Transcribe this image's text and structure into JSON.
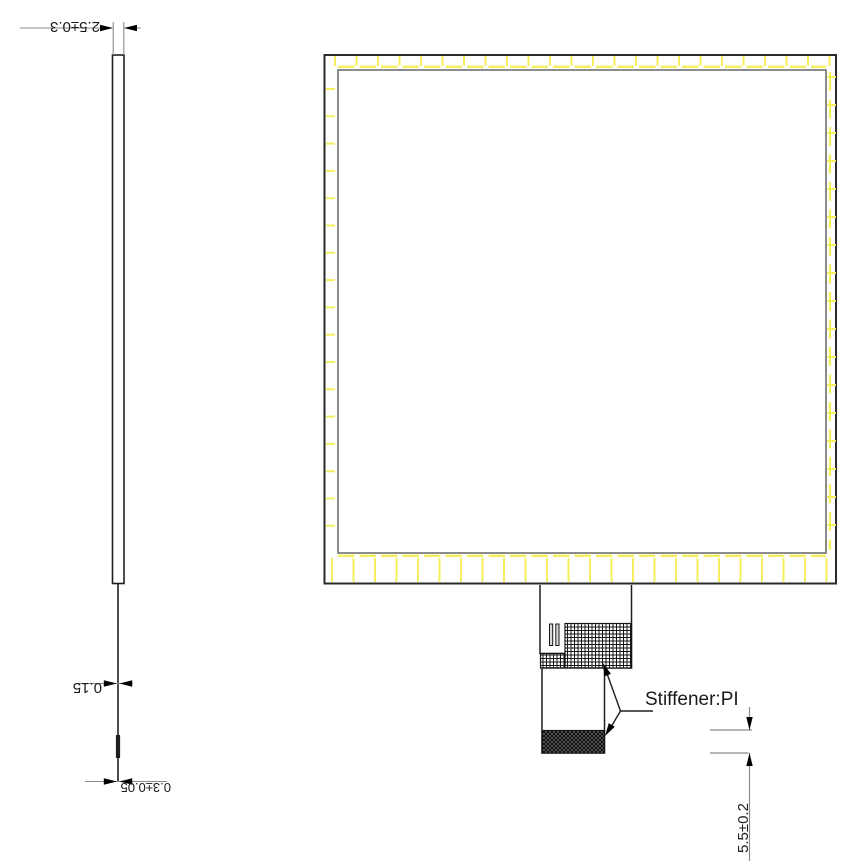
{
  "side_view": {
    "dims": {
      "overall_thickness": "2.5±0.3",
      "fpc_thickness": "0.15",
      "stiffener_thickness": "0.3±0.05"
    }
  },
  "front_view": {
    "stiffener_label": "Stiffener:PI",
    "dims": {
      "stiffener_height": "5.5±0.2"
    }
  },
  "colors": {
    "tape_yellow": "#f5ef5e",
    "outline_black": "#1f1f1f",
    "inner_border_grey": "#6f6f6f",
    "dim_line_grey": "#8a8a8a"
  }
}
